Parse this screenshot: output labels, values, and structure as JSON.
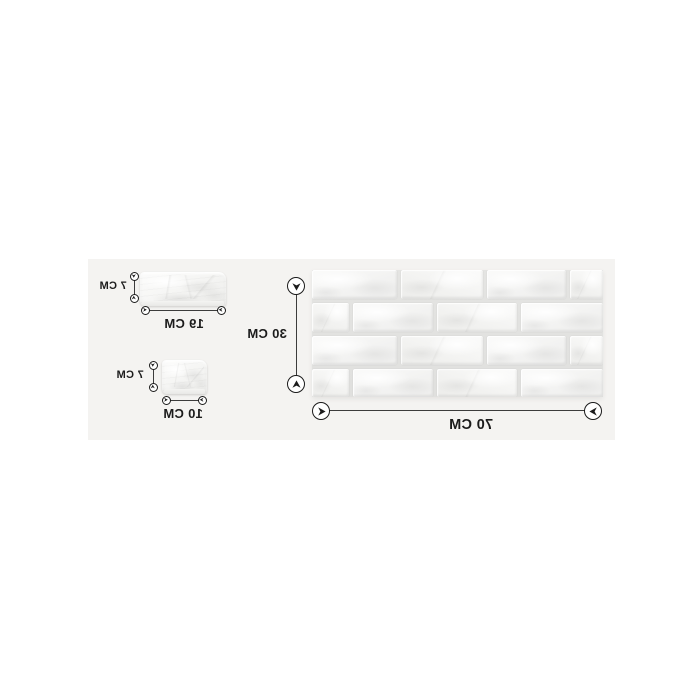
{
  "colors": {
    "page_bg": "#ffffff",
    "photo_bg": "#f4f3f1",
    "ink": "#1b1b1b",
    "line": "#3c3c3c",
    "mortar": "#e4e4e2",
    "brick": "#f7f7f6"
  },
  "samples": {
    "large_panel": {
      "width_label": "70 CM",
      "height_label": "30 CM"
    },
    "brick_19": {
      "width_label": "19 CM",
      "height_label": "7 CM"
    },
    "brick_10": {
      "width_label": "10 CM",
      "height_label": "7 CM"
    }
  }
}
